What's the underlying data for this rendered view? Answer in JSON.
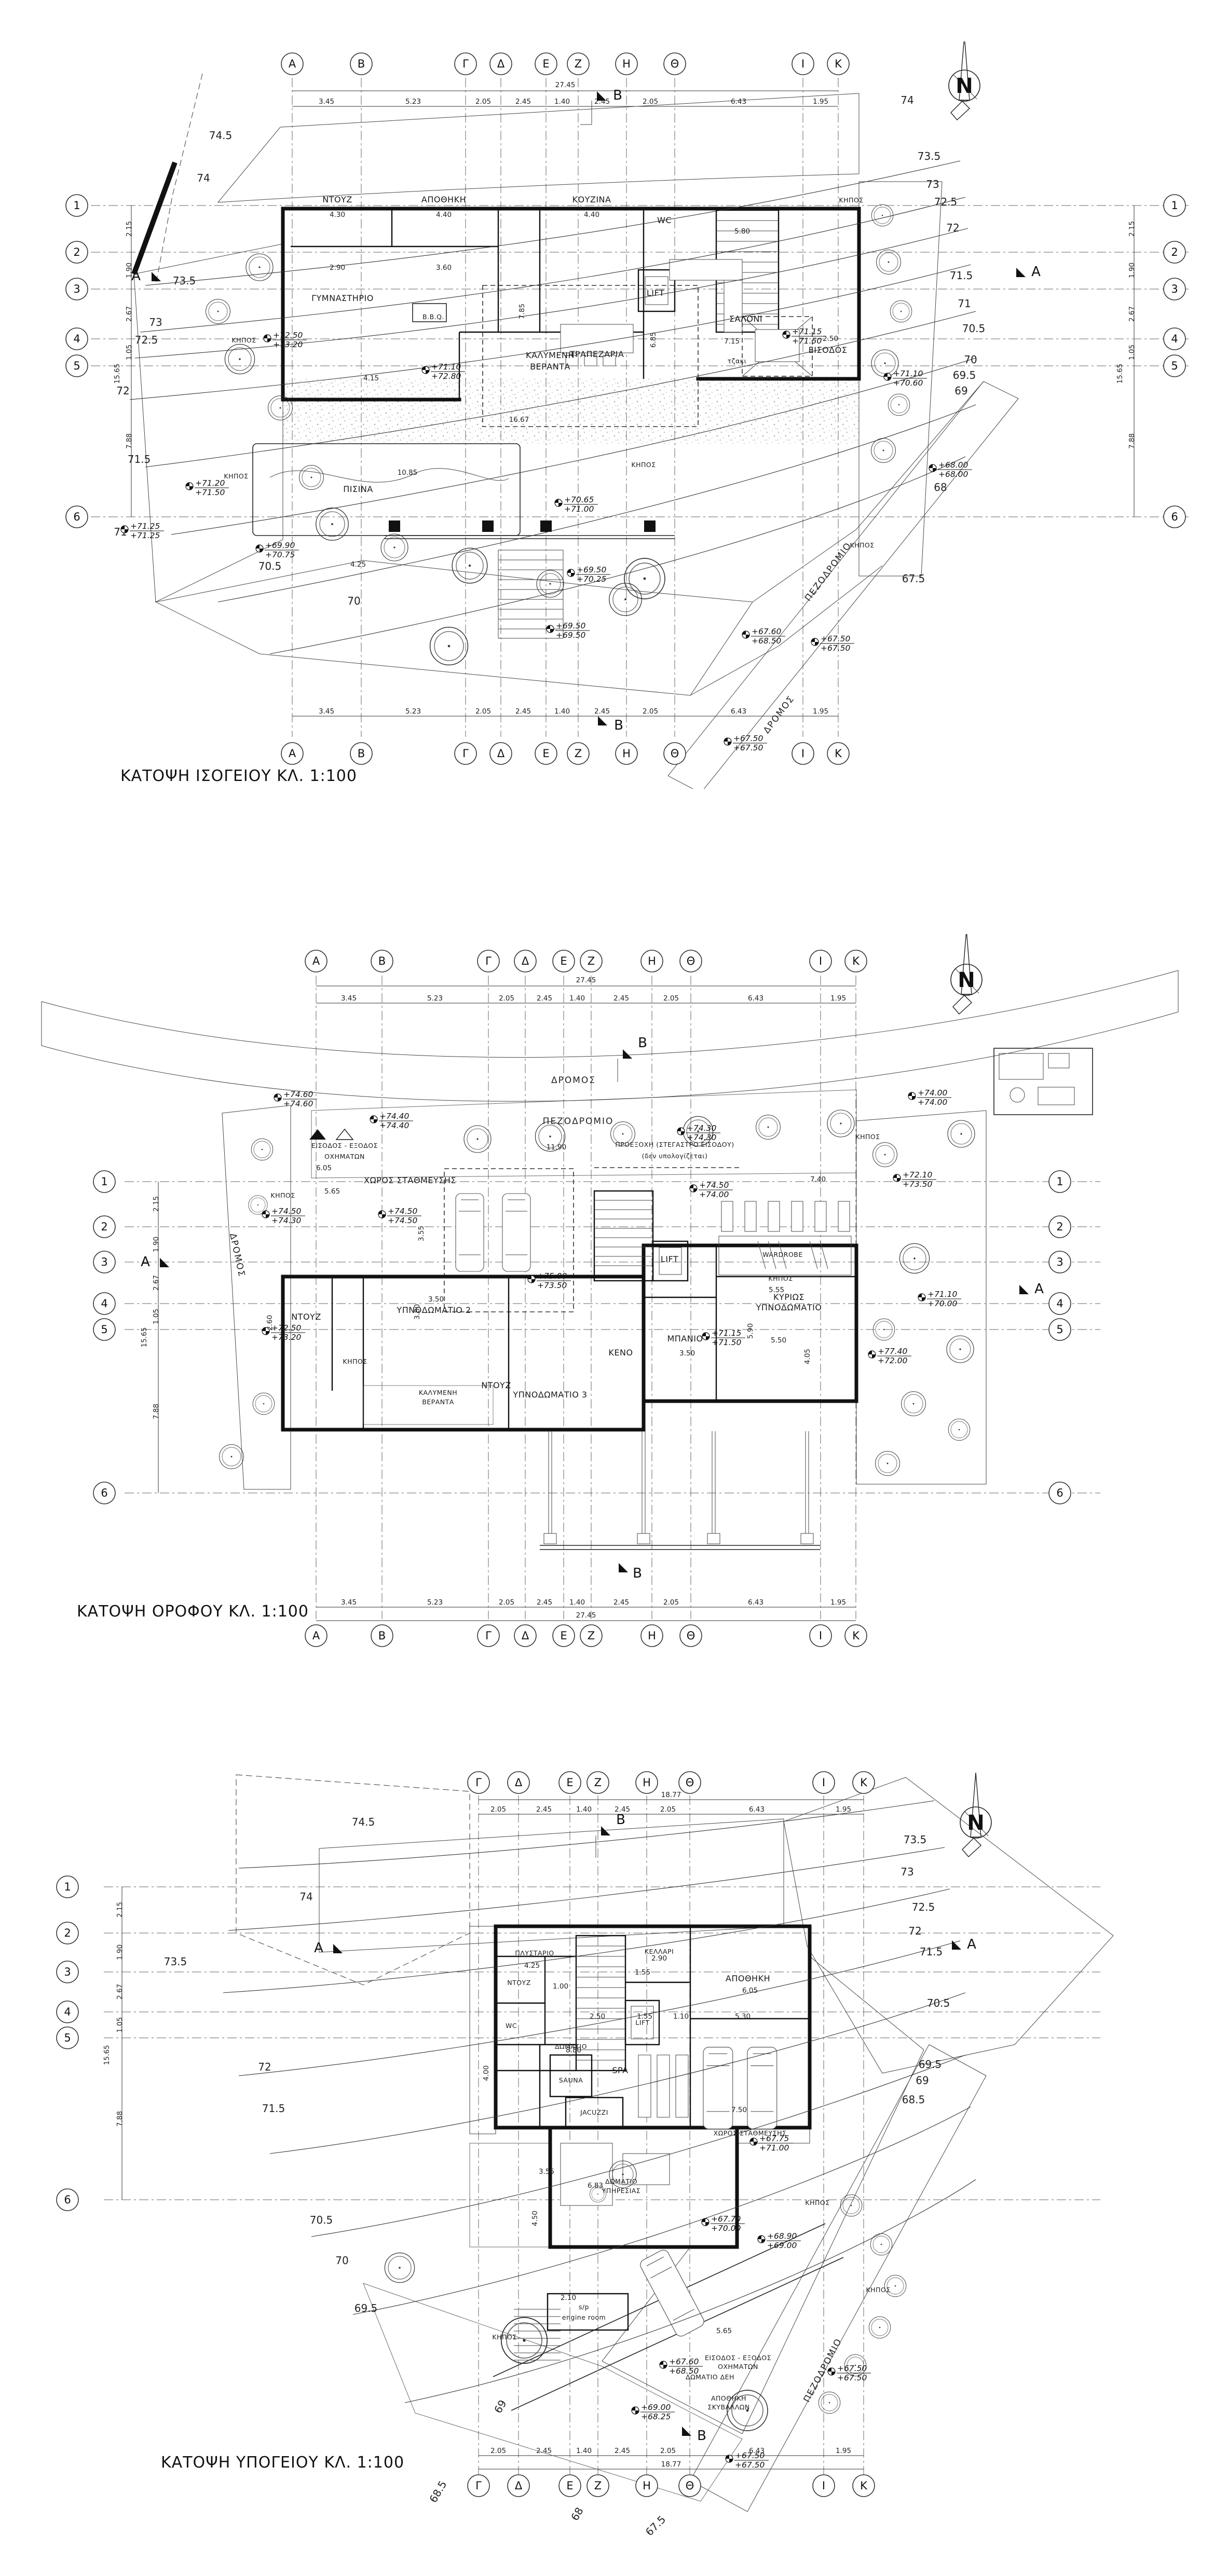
{
  "titles": {
    "ground": "ΚΑΤΟΨΗ ΙΣΟΓΕΙΟΥ ΚΛ. 1:100",
    "floor": "ΚΑΤΟΨΗ ΟΡΟΦΟΥ ΚΛ. 1:100",
    "basement": "ΚΑΤΟΨΗ ΥΠΟΓΕΙΟΥ  ΚΛ. 1:100"
  },
  "north_label": "N",
  "sections": {
    "a": "A",
    "b": "B"
  },
  "roads": {
    "dromos": "ΔΡΟΜΟΣ",
    "pezodromio": "ΠΕΖΟΔΡΟΜΙΟ"
  },
  "grid": {
    "letters": [
      "Α",
      "Β",
      "Γ",
      "Δ",
      "Ε",
      "Ζ",
      "Η",
      "Θ",
      "Ι",
      "Κ"
    ],
    "letters_basement": [
      "Γ",
      "Δ",
      "Ε",
      "Ζ",
      "Η",
      "Θ",
      "Ι",
      "Κ"
    ],
    "numbers": [
      "1",
      "2",
      "3",
      "4",
      "5",
      "6"
    ],
    "col_dims": [
      "3.45",
      "5.23",
      "2.05",
      "2.45",
      "1.40",
      "2.45",
      "2.05",
      "6.43",
      "1.95"
    ],
    "col_total": "27.45",
    "col_dims_basement": [
      "2.05",
      "2.45",
      "1.40",
      "2.45",
      "2.05",
      "6.43",
      "1.95"
    ],
    "col_total_basement": "18.77",
    "row_dims": [
      "2.15",
      "1.90",
      "2.67",
      "1.05",
      "7.88"
    ],
    "row_total": "15.65"
  },
  "plans": {
    "ground": {
      "rooms": {
        "ntouz": "ΝΤΟΥΖ",
        "apothiki": "ΑΠΟΘΗΚΗ",
        "kouzina": "ΚΟΥΖΙΝΑ",
        "wc": "WC",
        "lift": "LIFT",
        "gym": "ΓΥΜΝΑΣΤΗΡΙΟ",
        "saloni": "ΣΑΛΟΝΙ",
        "trapezaria": "ΤΡΑΠΕΖΑΡΙΑ",
        "tzaki": "τζακι",
        "eisodos": "ΕΙΣΟΔΟΣ",
        "veranta1": "ΚΑΛΥΜΕΝΗ",
        "veranta2": "ΒΕΡΑΝΤΑ",
        "bbq": "B.B.Q.",
        "pisina": "ΠΙΣΙΝΑ",
        "kipos": "ΚΗΠΟΣ"
      },
      "contours_left": [
        "74.5",
        "74",
        "73.5",
        "73",
        "72.5",
        "72",
        "71.5",
        "71"
      ],
      "contours_right": [
        "74",
        "73.5",
        "73",
        "72.5",
        "72",
        "71.5",
        "71",
        "70.5",
        "70",
        "69.5",
        "69",
        "68"
      ],
      "contours_bottom": [
        "70.5",
        "70",
        "67.5"
      ],
      "elevations": [
        {
          "t": "+72.50",
          "b": "+73.20"
        },
        {
          "t": "+71.20",
          "b": "+71.50"
        },
        {
          "t": "+71.25",
          "b": "+71.25"
        },
        {
          "t": "+69.90",
          "b": "+70.75"
        },
        {
          "t": "+69.50",
          "b": "+70.25"
        },
        {
          "t": "+69.50",
          "b": "+69.50"
        },
        {
          "t": "+71.10",
          "b": "+72.80"
        },
        {
          "t": "+70.65",
          "b": "+71.00"
        },
        {
          "t": "+71.15",
          "b": "+71.50"
        },
        {
          "t": "+71.10",
          "b": "+70.60"
        },
        {
          "t": "+68.00",
          "b": "+68.00"
        },
        {
          "t": "+67.60",
          "b": "+68.50"
        },
        {
          "t": "+67.50",
          "b": "+67.50"
        },
        {
          "t": "+67.50",
          "b": "+67.50"
        }
      ],
      "dims": [
        "4.30",
        "4.40",
        "4.40",
        "2.90",
        "3.60",
        "7.85",
        "16.67",
        "4.15",
        "10.85",
        "5.80",
        "7.15",
        "6.85",
        "2.50",
        "4.25",
        "3.70",
        "1.80",
        "0.90",
        "1.00",
        "3.80",
        "2.45",
        "4.05",
        "2.00",
        "1.55",
        "2.05",
        "4.10",
        "4.60",
        "2.72",
        "1.70",
        "3.32",
        "0.35",
        "1.50",
        "4.90",
        "2.35",
        "0.93"
      ]
    },
    "floor": {
      "rooms": {
        "parking": "ΧΩΡΟΣ ΣΤΑΘΜΕΥΣΗΣ",
        "entry1": "ΕΙΣΟΔΟΣ - ΕΞΟΔΟΣ",
        "entry2": "ΟΧΗΜΑΤΩΝ",
        "proexohi1": "ΠΡΟΕΞΟΧΗ (ΣΤΕΓΑΣΤΡΟ ΕΙΣΟΔΟΥ)",
        "proexohi2": "(δεν υπολογίζεται)",
        "bedroom2": "ΥΠΝΟΔΩΜΑΤΙΟ 2",
        "bedroom3": "ΥΠΝΟΔΩΜΑΤΙΟ 3",
        "master1": "ΚΥΡΙΩΣ",
        "master2": "ΥΠΝΟΔΩΜΑΤΙΟ",
        "ntouz": "ΝΤΟΥΖ",
        "banio": "ΜΠΑΝΙΟ",
        "wardrobe": "WARDROBE",
        "lift": "LIFT",
        "keno": "ΚΕΝΟ",
        "veranta1": "ΚΑΛΥΜΕΝΗ",
        "veranta2": "ΒΕΡΑΝΤΑ",
        "kipos": "ΚΗΠΟΣ"
      },
      "elevations": [
        {
          "t": "+74.60",
          "b": "+74.60"
        },
        {
          "t": "+74.00",
          "b": "+74.00"
        },
        {
          "t": "+74.40",
          "b": "+74.40"
        },
        {
          "t": "+74.50",
          "b": "+74.30"
        },
        {
          "t": "+74.50",
          "b": "+74.50"
        },
        {
          "t": "+75.00",
          "b": "+73.50"
        },
        {
          "t": "+72.50",
          "b": "+73.20"
        },
        {
          "t": "+74.30",
          "b": "+74.30"
        },
        {
          "t": "+74.50",
          "b": "+74.00"
        },
        {
          "t": "+72.10",
          "b": "+73.50"
        },
        {
          "t": "+71.10",
          "b": "+70.00"
        },
        {
          "t": "+77.40",
          "b": "+72.00"
        },
        {
          "t": "+71.15",
          "b": "+71.50"
        }
      ],
      "dims": [
        "6.05",
        "5.65",
        "7.40",
        "3.55",
        "2.60",
        "3.50",
        "3.80",
        "5.55",
        "5.90",
        "5.50",
        "4.05",
        "3.50",
        "11.90",
        "2.30",
        "1.75",
        "4.10",
        "1.50",
        "1.10",
        "0.25",
        "1.40",
        "3.05",
        "1.50",
        "3.15",
        "1.55",
        "2.05",
        "2.35",
        "2.48",
        "2.00",
        "2.10",
        "3.35",
        "1.95",
        "0.95",
        "2.15",
        "3.00",
        "3.56"
      ]
    },
    "basement": {
      "rooms": {
        "plystario": "ΠΛΥΣΤΑΡΙΟ",
        "ntouz": "ΝΤΟΥΖ",
        "wc": "WC",
        "kellari": "ΚΕΛΛΑΡΙ",
        "lift": "LIFT",
        "apothiki": "ΑΠΟΘΗΚΗ",
        "sauna1": "ΔΩΜΑΤΙΟ",
        "sauna2": "SAUNA",
        "spa": "SPA",
        "jacuzzi": "JACUZZI",
        "parking": "ΧΩΡΟΣ ΣΤΑΘΜΕΥΣΗΣ",
        "service1": "ΔΩΜΑΤΙΟ",
        "service2": "ΥΠΗΡΕΣΙΑΣ",
        "engine1": "s/p",
        "engine2": "engine room",
        "dei": "ΔΩΜΑΤΙΟ ΔΕΗ",
        "garbage1": "ΑΠΟΘΗΚΗ",
        "garbage2": "ΣΚΥΒΑΛΛΩΝ",
        "entry1": "ΕΙΣΟΔΟΣ - ΕΞΟΔΟΣ",
        "entry2": "ΟΧΗΜΑΤΩΝ",
        "kipos": "ΚΗΠΟΣ"
      },
      "contours_left": [
        "74.5",
        "74",
        "73.5",
        "72",
        "71.5",
        "70.5",
        "70",
        "69.5"
      ],
      "contours_right": [
        "73.5",
        "73",
        "72.5",
        "72",
        "71.5",
        "70.5",
        "69.5",
        "69",
        "68.5"
      ],
      "contours_bottom": [
        "69",
        "68.5",
        "68",
        "67.5"
      ],
      "elevations": [
        {
          "t": "+67.70",
          "b": "+70.00"
        },
        {
          "t": "+68.90",
          "b": "+69.00"
        },
        {
          "t": "+67.60",
          "b": "+68.50"
        },
        {
          "t": "+67.50",
          "b": "+67.50"
        },
        {
          "t": "+69.00",
          "b": "+68.25"
        },
        {
          "t": "+67.75",
          "b": "+71.00"
        },
        {
          "t": "+67.50",
          "b": "+67.50"
        }
      ],
      "dims": [
        "4.25",
        "1.00",
        "2.90",
        "1.55",
        "6.05",
        "2.50",
        "1.55",
        "1.10",
        "5.30",
        "8.80",
        "4.00",
        "7.50",
        "3.55",
        "6.83",
        "4.50",
        "2.10",
        "5.65",
        "1.90",
        "1.20",
        "2.05",
        "2.55",
        "0.25",
        "1.45",
        "0.30",
        "3.00",
        "1.95",
        "2.15",
        "0.95",
        "1.40",
        "1.20",
        "0.50",
        "6.10"
      ]
    }
  }
}
